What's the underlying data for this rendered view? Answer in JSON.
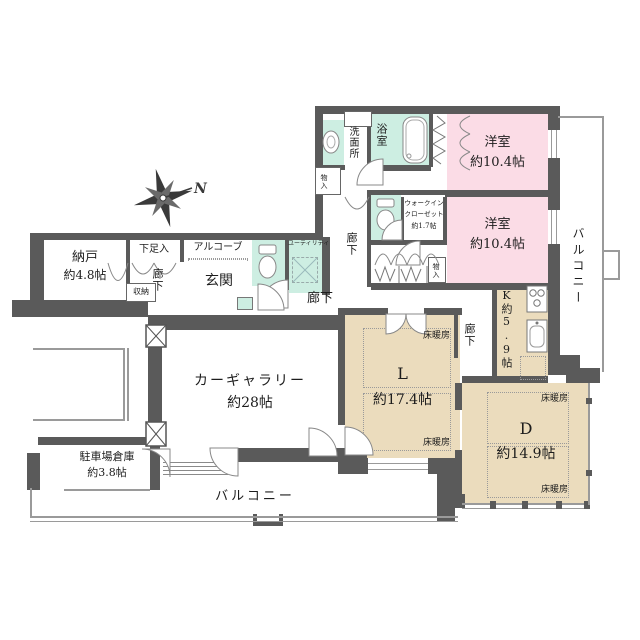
{
  "colors": {
    "wall": "#5a5a5a",
    "room_pink": "#fbdce6",
    "room_mint": "#cdeee2",
    "room_beige": "#ebdcbd",
    "line": "#9a9a9a"
  },
  "compass": {
    "north": "N"
  },
  "labels": {
    "floor_heating": "床暖房",
    "corridor": "廊下",
    "closet": "物入",
    "balcony": "バルコニー"
  },
  "rooms": {
    "storage_room": {
      "name": "納戸",
      "size": "約4.8帖"
    },
    "shoe_cabinet": {
      "name": "下足入"
    },
    "storage_small": {
      "name": "収納"
    },
    "alcove": {
      "name": "アルコーブ"
    },
    "entrance": {
      "name": "玄関"
    },
    "utility": {
      "name": "ユーティリティ"
    },
    "washroom": {
      "name": "洗面所"
    },
    "bathroom": {
      "name": "浴室"
    },
    "bedroom_top": {
      "name": "洋室",
      "size": "約10.4帖"
    },
    "bedroom_mid": {
      "name": "洋室",
      "size": "約10.4帖"
    },
    "walk_in_closet": {
      "name_line1": "ウォークイン",
      "name_line2": "クローゼット",
      "size": "約1.7帖"
    },
    "kitchen": {
      "name": "K",
      "size": "約5.9帖"
    },
    "living": {
      "name": "L",
      "size": "約17.4帖"
    },
    "dining": {
      "name": "D",
      "size": "約14.9帖"
    },
    "car_gallery": {
      "name": "カーギャラリー",
      "size": "約28帖"
    },
    "parking_storage": {
      "name": "駐車場倉庫",
      "size": "約3.8帖"
    }
  }
}
